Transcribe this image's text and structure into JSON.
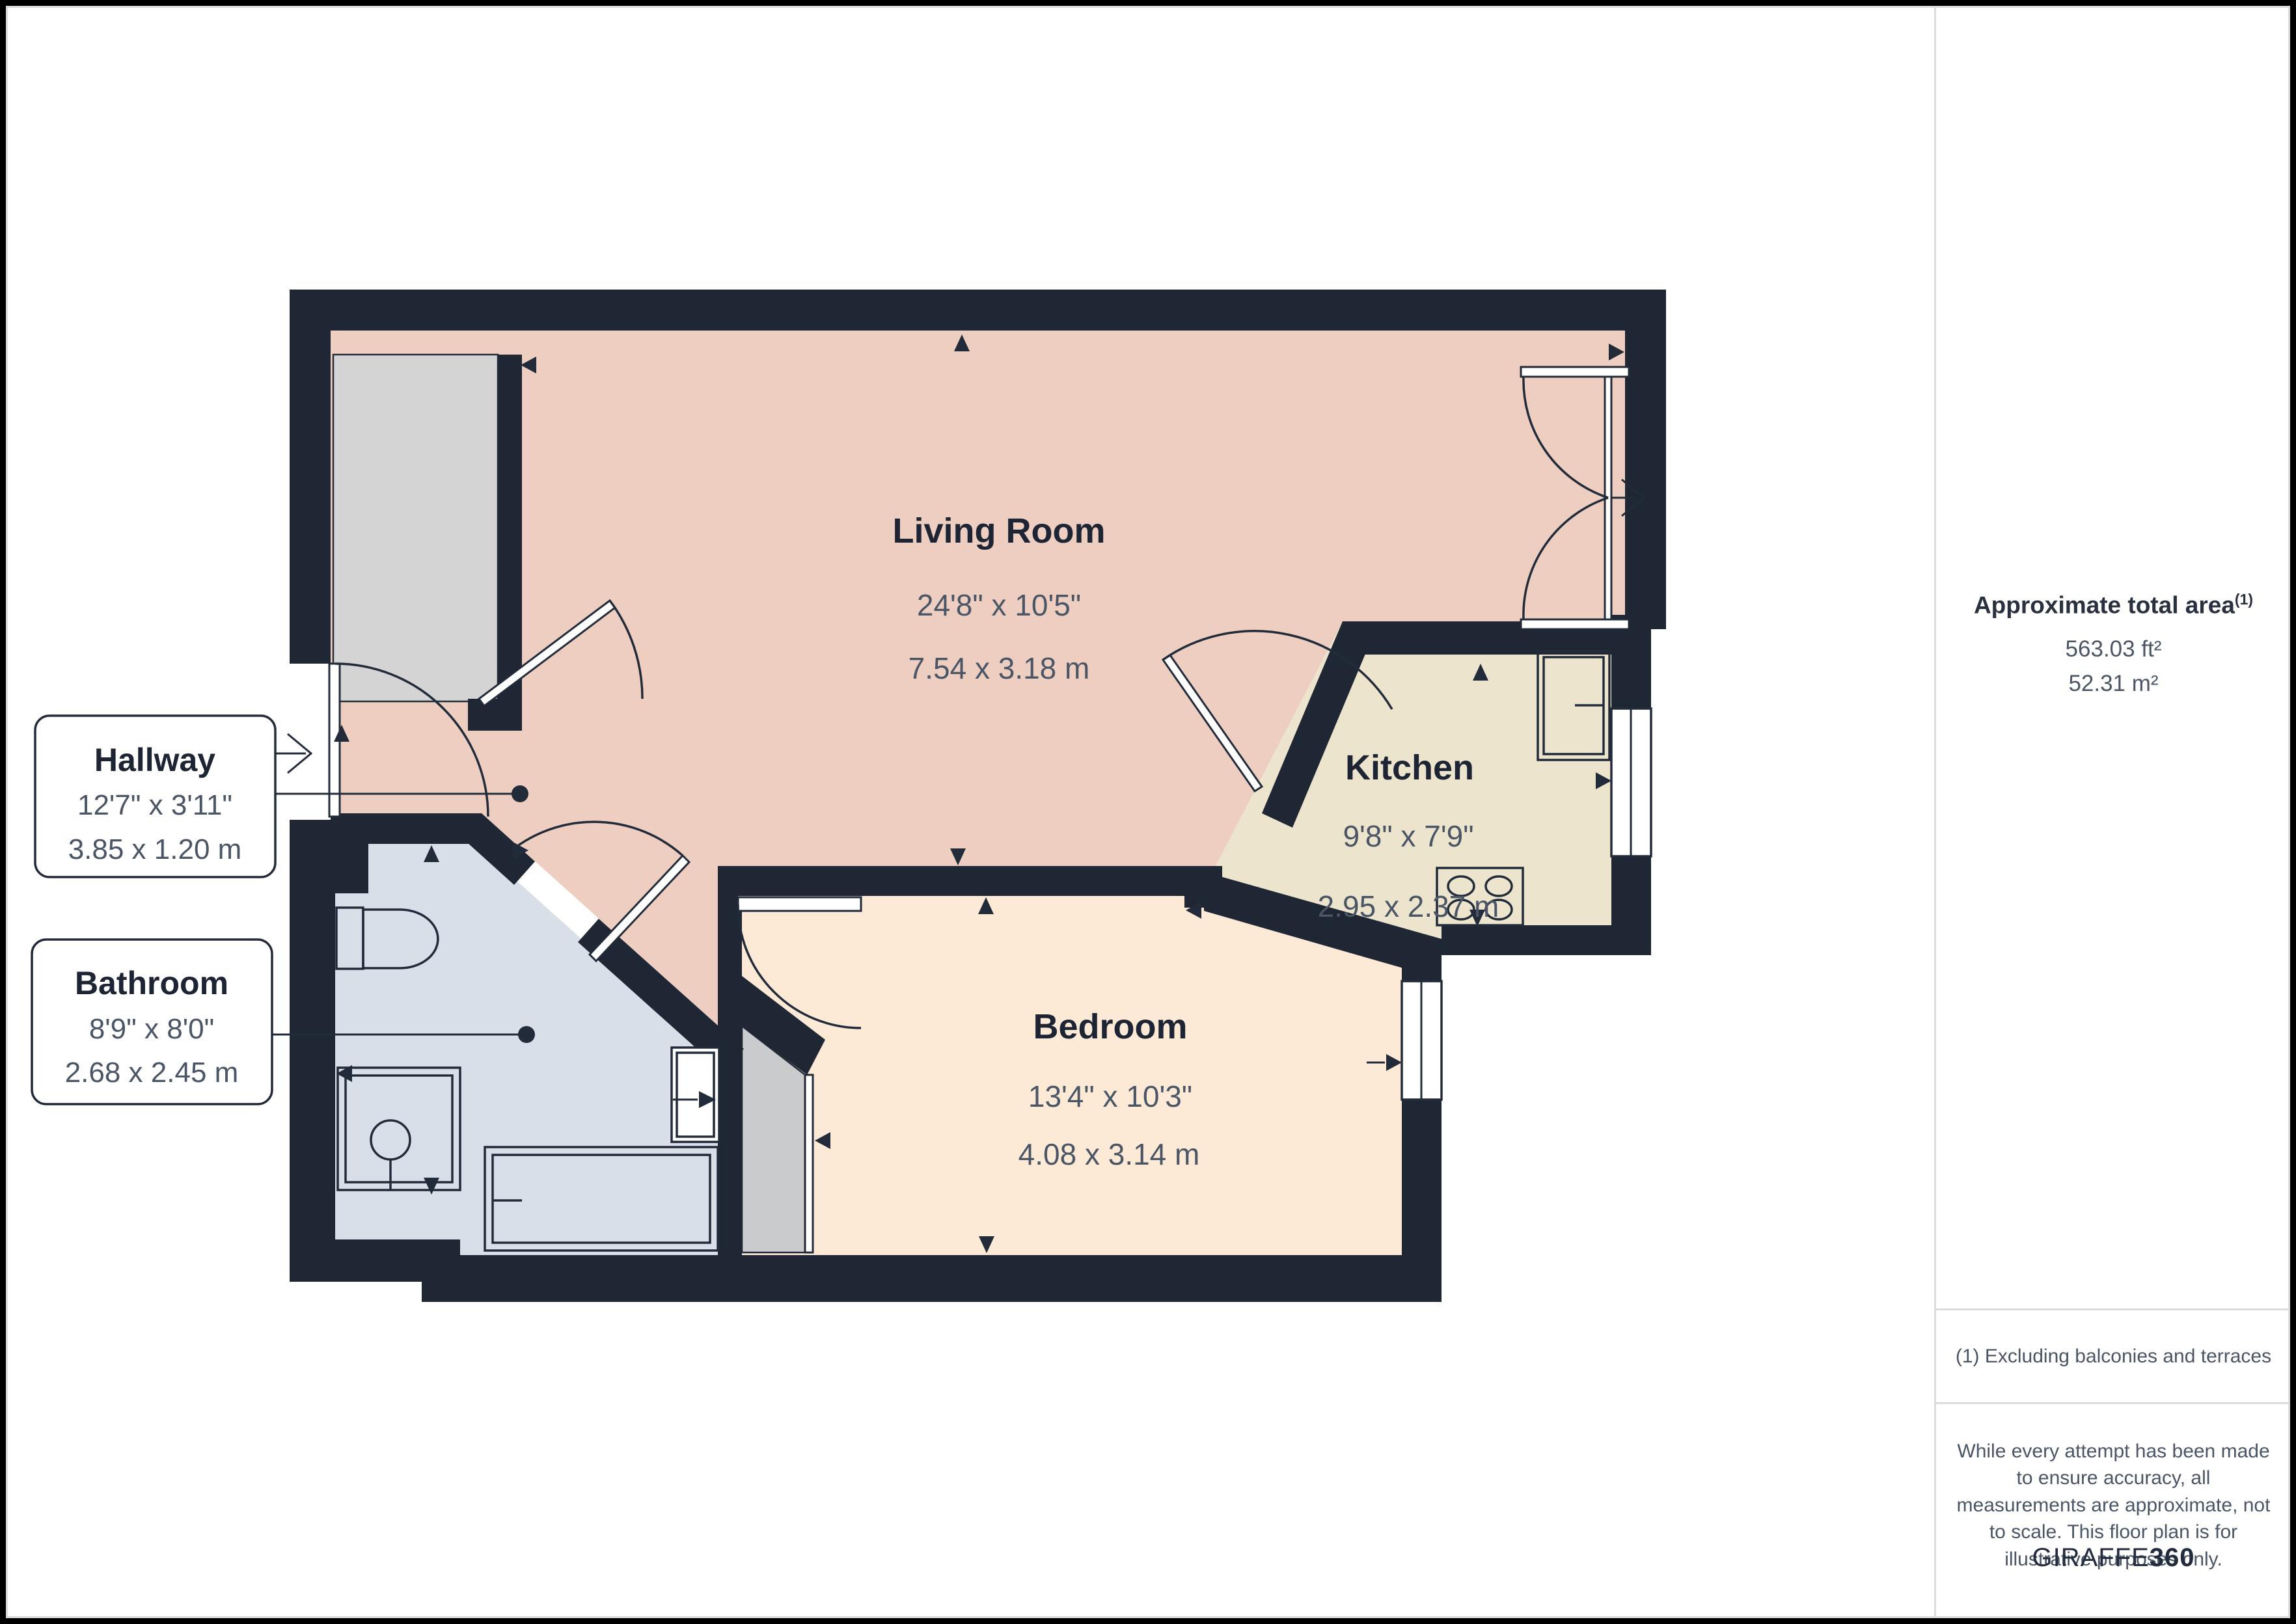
{
  "colors": {
    "wall": "#1f2634",
    "living_fill": "#edcec0",
    "bedroom_fill": "#fce9d6",
    "kitchen_fill": "#ece4cd",
    "bathroom_fill": "#d9dfe9",
    "storage_fill": "#d4d4d4",
    "closet_fill": "#c9cbcd",
    "arrow": "#222b3a"
  },
  "plan": {
    "rooms": [
      {
        "id": "living",
        "name": "Living Room",
        "imperial": "24'8\" x 10'5\"",
        "metric": "7.54 x 3.18 m"
      },
      {
        "id": "kitchen",
        "name": "Kitchen",
        "imperial": "9'8\" x 7'9\"",
        "metric": "2.95 x 2.37 m"
      },
      {
        "id": "bedroom",
        "name": "Bedroom",
        "imperial": "13'4\" x 10'3\"",
        "metric": "4.08 x 3.14 m"
      }
    ],
    "callouts": [
      {
        "id": "hallway",
        "name": "Hallway",
        "imperial": "12'7\" x 3'11\"",
        "metric": "3.85 x 1.20 m"
      },
      {
        "id": "bathroom",
        "name": "Bathroom",
        "imperial": "8'9\" x 8'0\"",
        "metric": "2.68 x 2.45 m"
      }
    ]
  },
  "sidebar": {
    "area_heading": "Approximate total area",
    "area_heading_sup": "(1)",
    "area_ft": "563.03 ft²",
    "area_m": "52.31 m²",
    "footnote": "(1) Excluding balconies and terraces",
    "disclaimer": "While every attempt has been made to ensure accuracy, all measurements are approximate, not to scale. This floor plan is for illustrative purposes only.",
    "brand_name": "GIRAFFE",
    "brand_suffix": "360"
  }
}
